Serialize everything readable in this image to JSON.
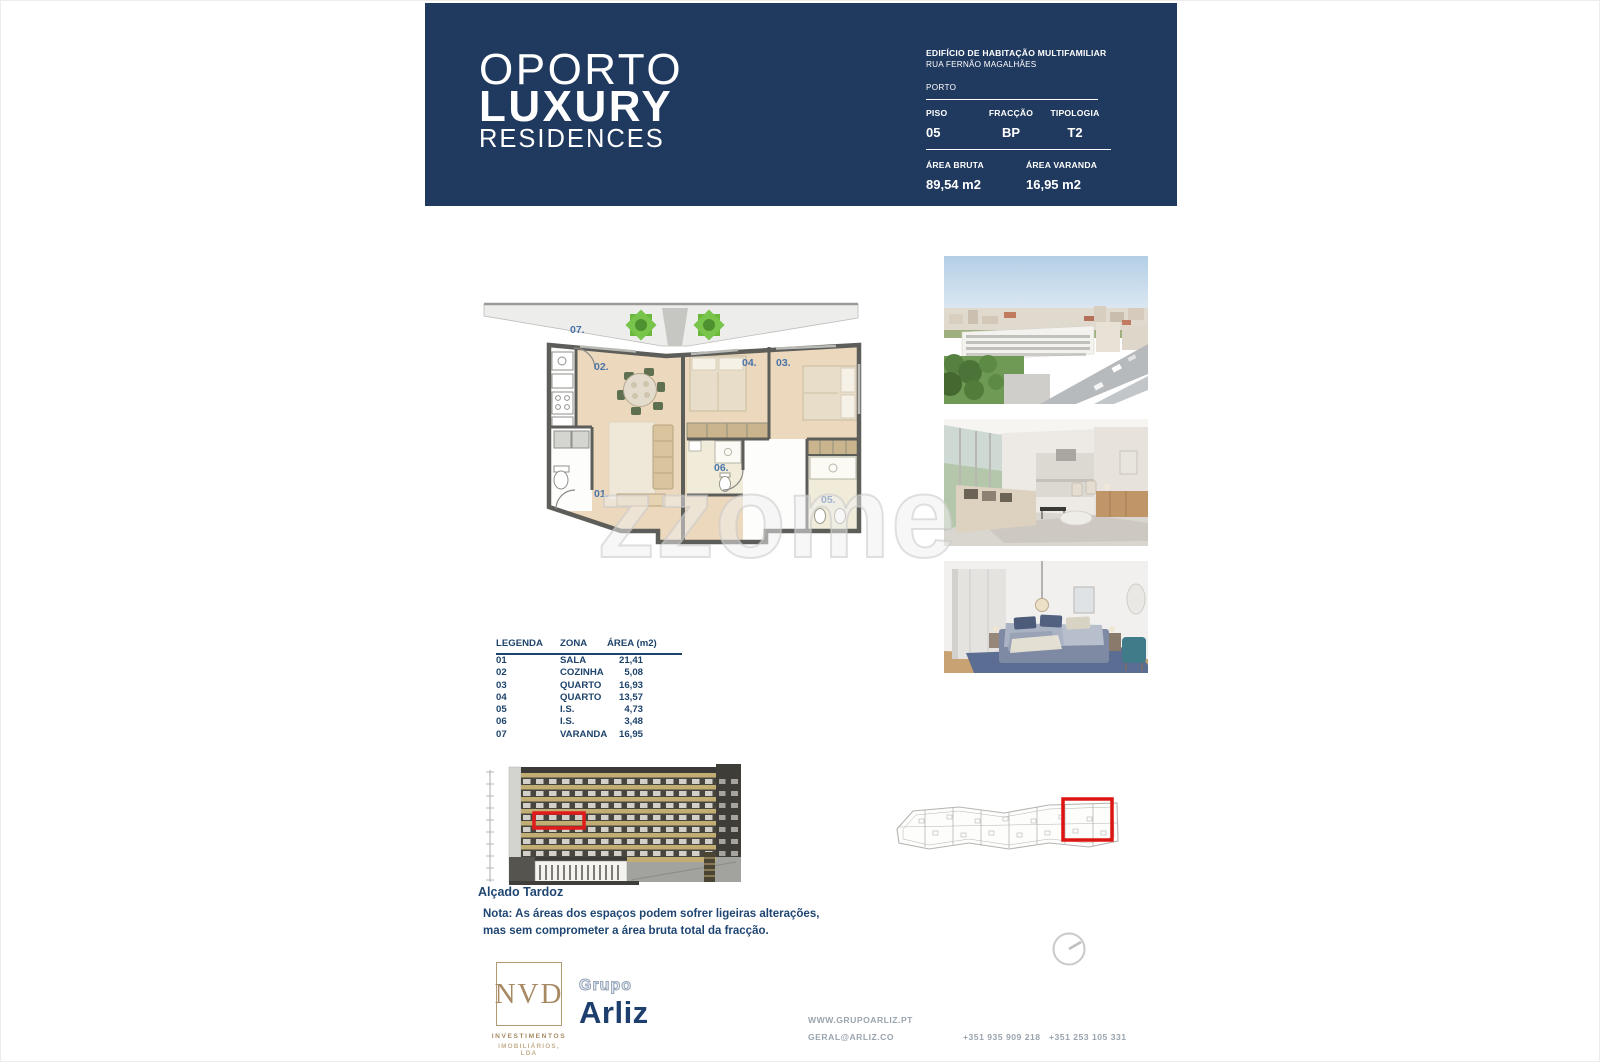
{
  "header": {
    "brand": {
      "line1": "OPORTO",
      "line2": "LUXURY",
      "line3": "RESIDENCES"
    },
    "building_title": "EDIFÍCIO DE HABITAÇÃO MULTIFAMILIAR",
    "street": "RUA FERNÃO MAGALHÃES",
    "city": "PORTO",
    "piso_label": "PISO",
    "piso_value": "05",
    "fraccao_label": "FRACÇÃO",
    "fraccao_value": "BP",
    "tipologia_label": "TIPOLOGIA",
    "tipologia_value": "T2",
    "area_bruta_label": "ÁREA BRUTA",
    "area_bruta_value": "89,54 m2",
    "area_varanda_label": "ÁREA VARANDA",
    "area_varanda_value": "16,95 m2"
  },
  "plan": {
    "labels": [
      {
        "text": "01."
      },
      {
        "text": "02."
      },
      {
        "text": "03."
      },
      {
        "text": "04."
      },
      {
        "text": "05."
      },
      {
        "text": "06."
      },
      {
        "text": "07."
      }
    ]
  },
  "legend": {
    "headers": [
      "LEGENDA",
      "ZONA",
      "ÁREA (m2)"
    ],
    "rows": [
      [
        "01",
        "SALA",
        "21,41"
      ],
      [
        "02",
        "COZINHA",
        "5,08"
      ],
      [
        "03",
        "QUARTO",
        "16,93"
      ],
      [
        "04",
        "QUARTO",
        "13,57"
      ],
      [
        "05",
        "I.S.",
        "4,73"
      ],
      [
        "06",
        "I.S.",
        "3,48"
      ],
      [
        "07",
        "VARANDA",
        "16,95"
      ]
    ]
  },
  "elevation": {
    "caption": "Alçado Tardoz"
  },
  "nota": {
    "line1": "Nota: As áreas dos espaços podem sofrer ligeiras alterações,",
    "line2": "mas sem comprometer a área bruta total da fracção."
  },
  "logos": {
    "nvd": {
      "name": "NVD",
      "sub1": "INVESTIMENTOS",
      "sub2": "IMOBILIÁRIOS, LDA"
    },
    "arliz": {
      "group": "Grupo",
      "name": "Arliz"
    }
  },
  "footer": {
    "website": "WWW.GRUPOARLIZ.PT",
    "email": "GERAL@ARLIZ.CO",
    "phone1": "+351 935 909 218",
    "phone2": "+351 253 105 331"
  },
  "watermark": {
    "text": "zzome"
  },
  "colors": {
    "band_navy": "#20395e",
    "text_navy": "#1e436b",
    "highlight_red": "#e11b1b",
    "nvd_gold": "#a78a63",
    "plan_floor_beige": "#ecd8bd",
    "elevation_tan": "#c2ae72"
  }
}
